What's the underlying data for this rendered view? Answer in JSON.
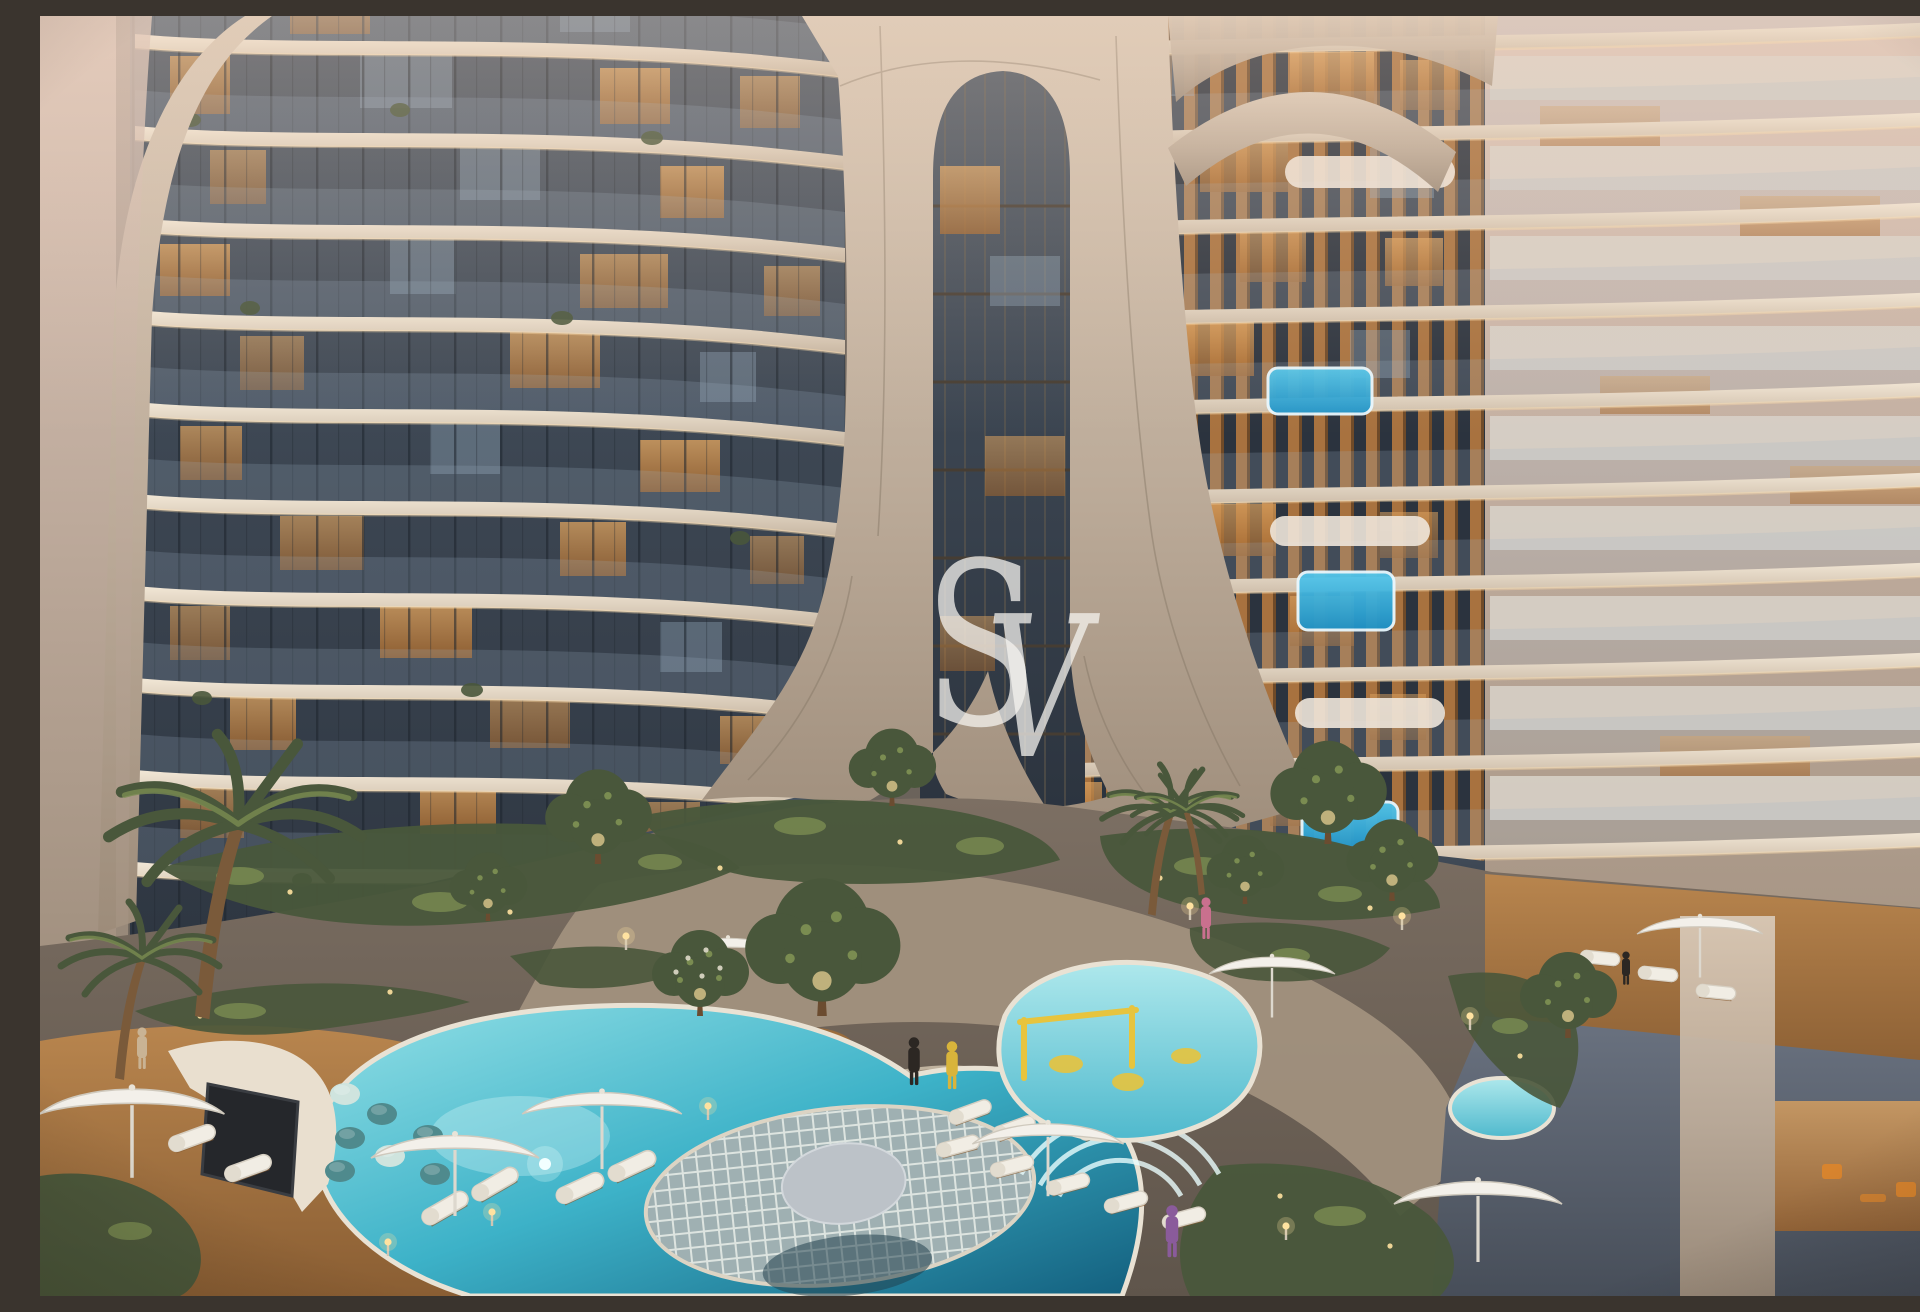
{
  "watermark": {
    "letter_s": "S",
    "letter_v": "V",
    "text": "SV"
  },
  "scene": {
    "description": "Dusk architectural rendering of a luxury residential complex: two curved-balcony towers joined by a sculptural cream arch over a landscaped courtyard with lagoon pools, kids pool, balcony plunge pools, wooden sun decks, loungers, umbrellas, bean bags by an outdoor cinema screen and palm trees"
  },
  "palette": {
    "facade_light": "#ecdfcd",
    "facade_cream": "#cdbdab",
    "facade_deep": "#a29180",
    "facade_pink": "#dcc6ba",
    "arch_cream": "#d8c8b6",
    "arch_mid": "#bcab99",
    "arch_shadow": "#9d8c7a",
    "seam": "#837564",
    "glass_dark": "#2b333e",
    "glass_mid": "#4a5562",
    "glass_sheen": "#aebdcb",
    "mullion": "#1d242c",
    "interior_warm": "#dca25f",
    "interior_ember": "#a4672d",
    "interior_cool": "#93a7ba",
    "slab_lit": "#ffdfad",
    "wood_slat": "#a8723f",
    "wood_slat_dark": "#6f4a28",
    "balustrade": "#d9d3ca",
    "plunge": "#55c8ec",
    "plunge_deep": "#1f93c8",
    "pool_shallow": "#93e0e6",
    "pool_teal": "#3db2c8",
    "pool_deep": "#135f7e",
    "pool_glow": "#e4fbfb",
    "kids_pool": "#84d8e0",
    "play_yellow": "#e7c43e",
    "deck": "#b8854e",
    "deck_dark": "#8a5e33",
    "ground": "#7c6f63",
    "ground_light": "#a3927f",
    "stone": "#b5a492",
    "green": "#49573b",
    "green_light": "#7a8c51",
    "glow": "#ffe2a0",
    "screen": "#25272b",
    "enclosure": "#e9dfcf",
    "beanbag": "#4f8a8d",
    "beanbag_light": "#cfe4de",
    "orange": "#d8842e",
    "terrace": "#5b6370",
    "umbrella": "#f3f0ea",
    "watermark": "#f6f4f0",
    "island": "#9fb0b2",
    "island_grid": "#dde4e0",
    "platform": "#bcc2c8",
    "person_yellow": "#d8b43b",
    "person_dark": "#2c2723",
    "person_pink": "#c9708e",
    "person_purple": "#8a5b9b",
    "person_tan": "#c9b394"
  }
}
